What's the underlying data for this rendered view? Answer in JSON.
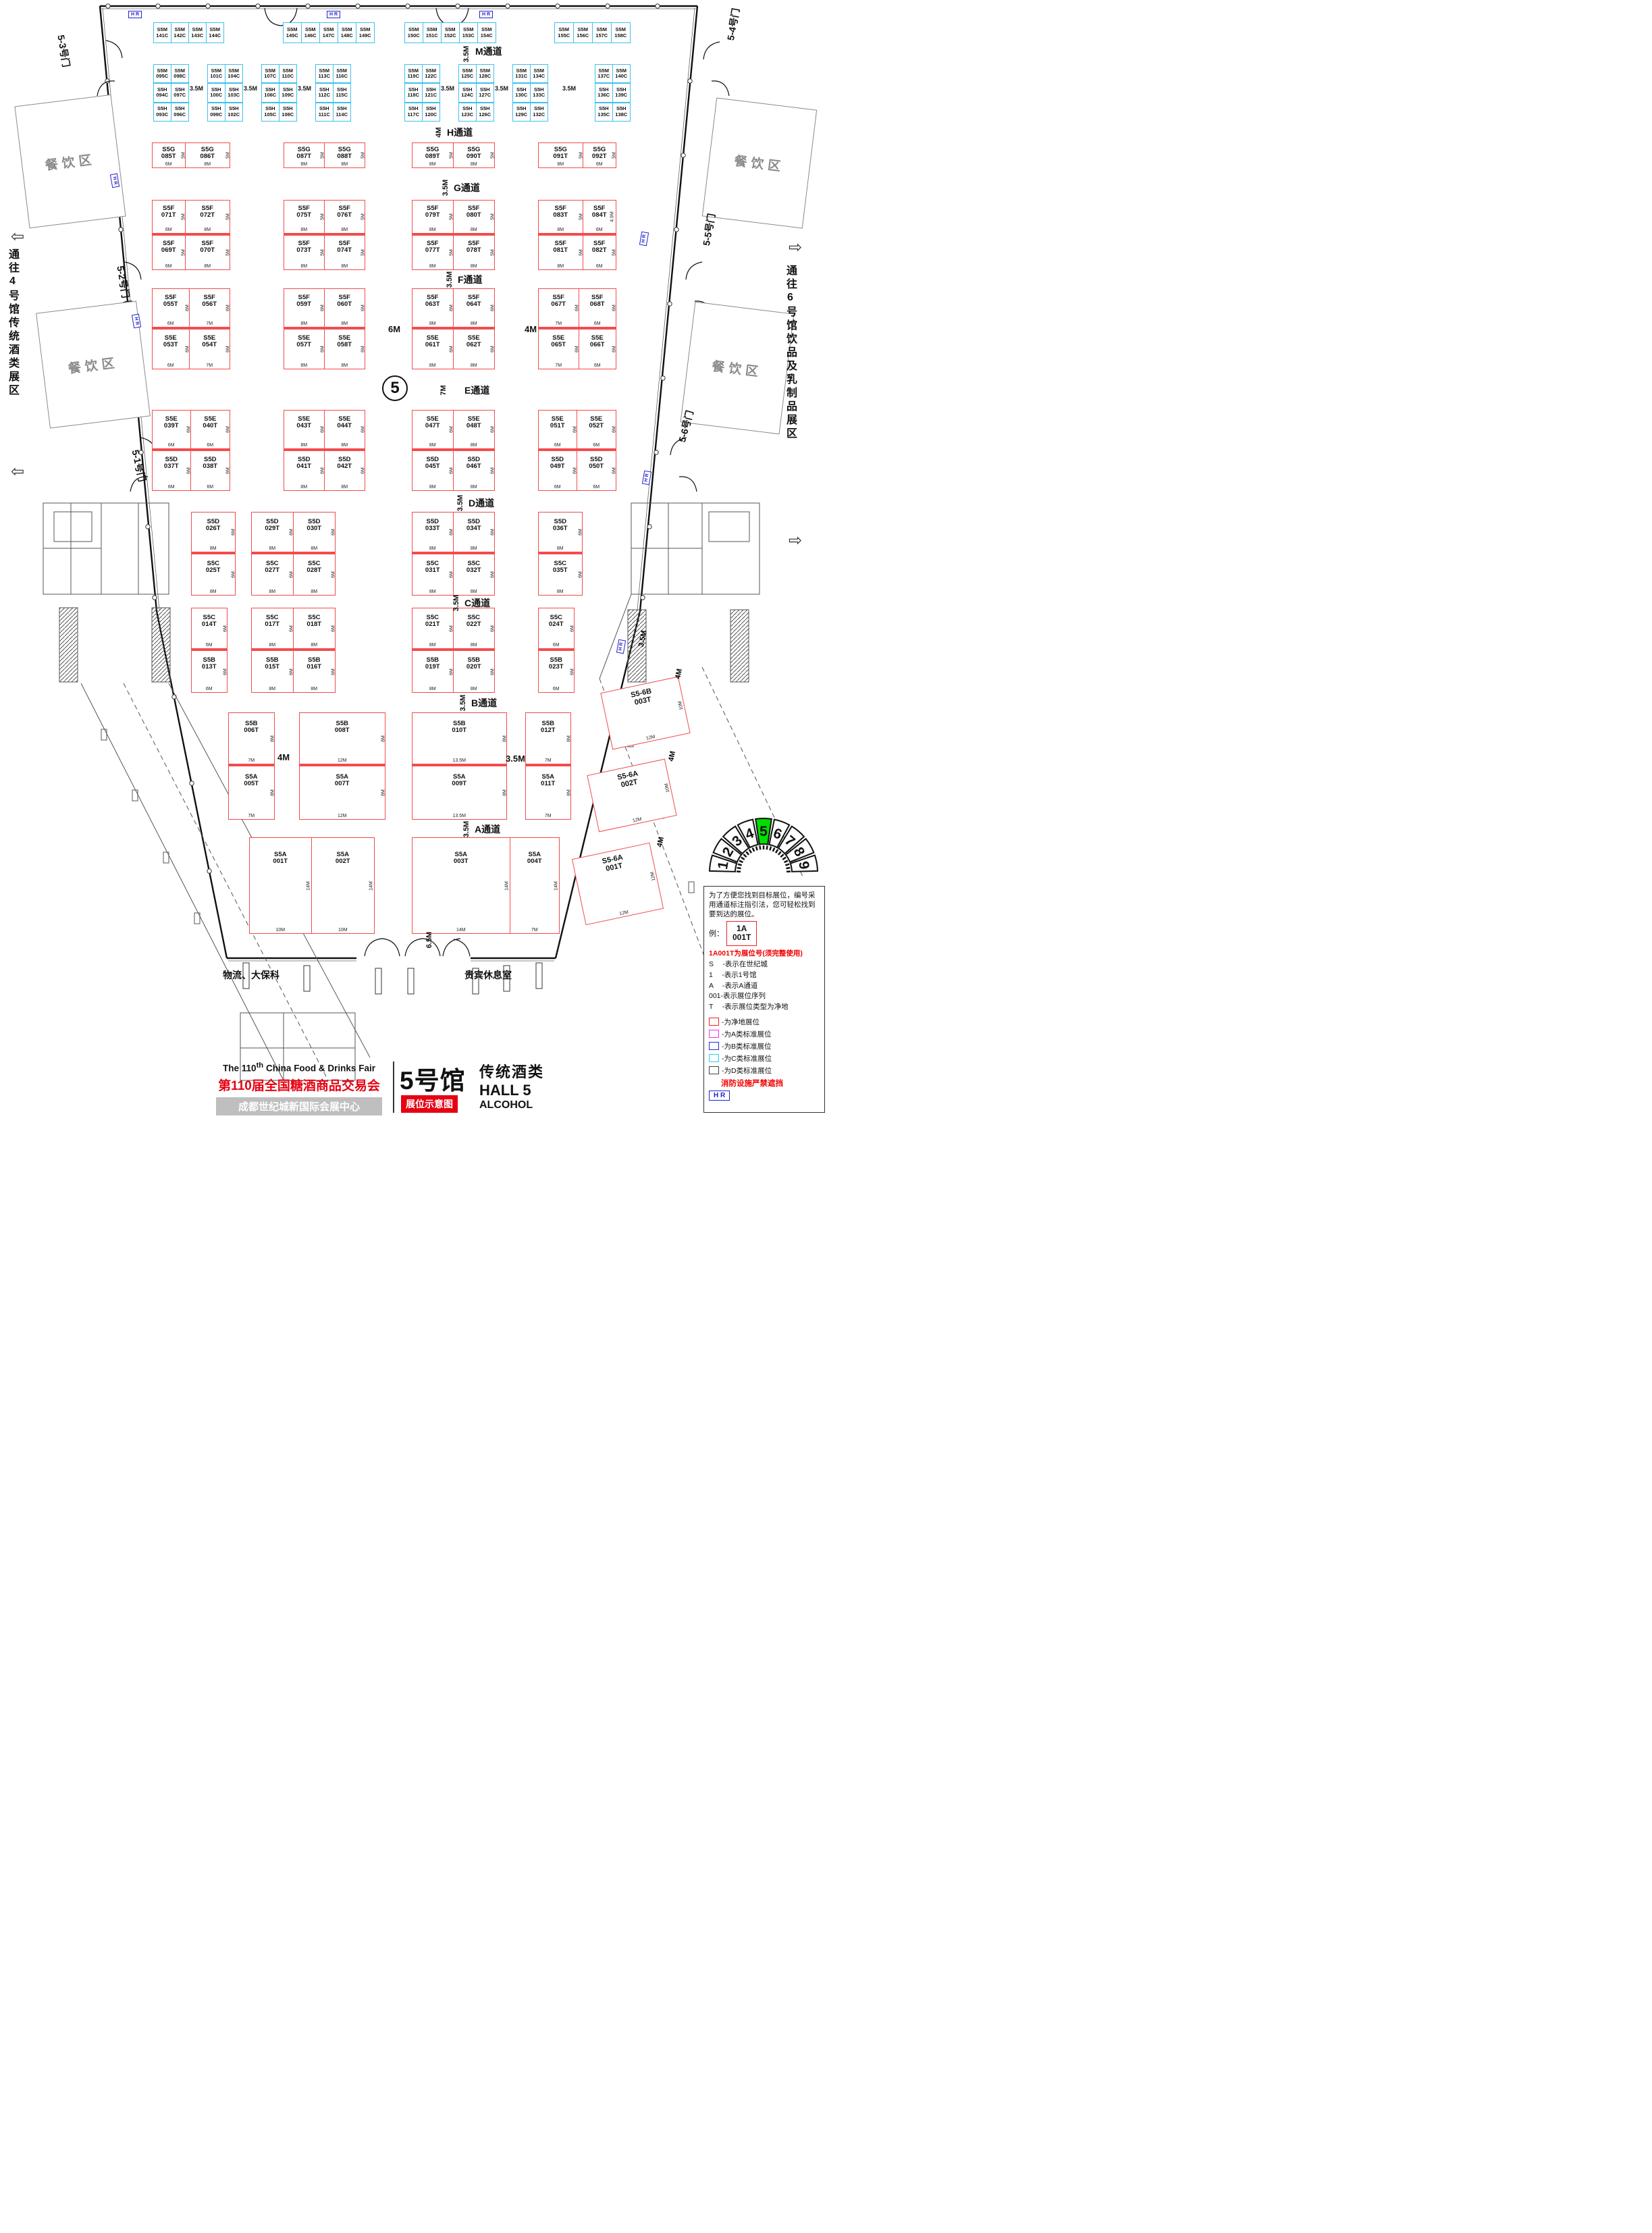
{
  "hall_circle": "5",
  "aisles": [
    {
      "dim": "3.5M",
      "name": "M通道"
    },
    {
      "dim": "4M",
      "name": "H通道"
    },
    {
      "dim": "3.5M",
      "name": "G通道"
    },
    {
      "dim": "3.5M",
      "name": "F通道"
    },
    {
      "dim": "7M",
      "name": "E通道"
    },
    {
      "dim": "3.5M",
      "name": "D通道"
    },
    {
      "dim": "3.5M",
      "name": "C通道"
    },
    {
      "dim": "3.5M",
      "name": "B通道"
    },
    {
      "dim": "3.5M",
      "name": "A通道"
    }
  ],
  "floating_dims": [
    "3.5M",
    "3.5M",
    "3.5M",
    "3.5M",
    "3.5M",
    "3.5M",
    "6M",
    "4M",
    "4M",
    "3.5M",
    "6.5M",
    "4M",
    "4M",
    "4M",
    "3.5M"
  ],
  "m_strip": [
    [
      "S5M 141C",
      "S5M 142C",
      "S5M 143C",
      "S5M 144C"
    ],
    [
      "S5M 145C",
      "S5M 146C",
      "S5M 147C",
      "S5M 148C",
      "S5M 149C"
    ],
    [
      "S5M 150C",
      "S5M 151C",
      "S5M 152C",
      "S5M 153C",
      "S5M 154C"
    ],
    [
      "S5M 155C",
      "S5M 156C",
      "S5M 157C",
      "S5M 158C"
    ]
  ],
  "mh_blocks": [
    [
      [
        "S5M 095C",
        "S5H 094C",
        "S5H 093C"
      ],
      [
        "S5M 098C",
        "S5H 097C",
        "S5H 096C"
      ]
    ],
    [
      [
        "S5M 101C",
        "S5H 100C",
        "S5H 099C"
      ],
      [
        "S5M 104C",
        "S5H 103C",
        "S5H 102C"
      ]
    ],
    [
      [
        "S5M 107C",
        "S5H 106C",
        "S5H 105C"
      ],
      [
        "S5M 110C",
        "S5H 109C",
        "S5H 108C"
      ]
    ],
    [
      [
        "S5M 113C",
        "S5H 112C",
        "S5H 111C"
      ],
      [
        "S5M 116C",
        "S5H 115C",
        "S5H 114C"
      ]
    ],
    [
      [
        "S5M 119C",
        "S5H 118C",
        "S5H 117C"
      ],
      [
        "S5M 122C",
        "S5H 121C",
        "S5H 120C"
      ]
    ],
    [
      [
        "S5M 125C",
        "S5H 124C",
        "S5H 123C"
      ],
      [
        "S5M 128C",
        "S5H 127C",
        "S5H 126C"
      ]
    ],
    [
      [
        "S5M 131C",
        "S5H 130C",
        "S5H 129C"
      ],
      [
        "S5M 134C",
        "S5H 133C",
        "S5H 132C"
      ]
    ],
    [
      [
        "S5M 137C",
        "S5H 136C",
        "S5H 135C"
      ],
      [
        "S5M 140C",
        "S5H 139C",
        "S5H 138C"
      ]
    ]
  ],
  "bands": {
    "g": [
      [
        [
          "S5G 085T",
          "6M",
          "5M"
        ],
        [
          "S5G 086T",
          "8M",
          "5M"
        ]
      ],
      [
        [
          "S5G 087T",
          "8M",
          "5M"
        ],
        [
          "S5G 088T",
          "8M",
          "5M"
        ]
      ],
      [
        [
          "S5G 089T",
          "8M",
          "5M"
        ],
        [
          "S5G 090T",
          "8M",
          "5M"
        ]
      ],
      [
        [
          "S5G 091T",
          "8M",
          "5M"
        ],
        [
          "S5G 092T",
          "6M",
          "5M"
        ]
      ]
    ],
    "f1": [
      [
        [
          "S5F 071T",
          "6M",
          "5M"
        ],
        [
          "S5F 072T",
          "8M",
          "5M"
        ]
      ],
      [
        [
          "S5F 075T",
          "8M",
          "5M"
        ],
        [
          "S5F 076T",
          "8M",
          "5M"
        ]
      ],
      [
        [
          "S5F 079T",
          "8M",
          "5M"
        ],
        [
          "S5F 080T",
          "8M",
          "5M"
        ]
      ],
      [
        [
          "S5F 083T",
          "8M",
          "5M"
        ],
        [
          "S5F 084T",
          "6M",
          "4.9M"
        ]
      ]
    ],
    "f2": [
      [
        [
          "S5F 069T",
          "6M",
          "5M"
        ],
        [
          "S5F 070T",
          "8M",
          "5M"
        ]
      ],
      [
        [
          "S5F 073T",
          "8M",
          "5M"
        ],
        [
          "S5F 074T",
          "8M",
          "5M"
        ]
      ],
      [
        [
          "S5F 077T",
          "8M",
          "5M"
        ],
        [
          "S5F 078T",
          "8M",
          "5M"
        ]
      ],
      [
        [
          "S5F 081T",
          "8M",
          "5M"
        ],
        [
          "S5F 082T",
          "6M",
          "5M"
        ]
      ]
    ],
    "e1": [
      [
        [
          "S5F 055T",
          "6M",
          "6M"
        ],
        [
          "S5F 056T",
          "7M",
          "6M"
        ]
      ],
      [
        [
          "S5F 059T",
          "8M",
          "6M"
        ],
        [
          "S5F 060T",
          "8M",
          "6M"
        ]
      ],
      [
        [
          "S5F 063T",
          "8M",
          "6M"
        ],
        [
          "S5F 064T",
          "8M",
          "6M"
        ]
      ],
      [
        [
          "S5F 067T",
          "7M",
          "6M"
        ],
        [
          "S5F 068T",
          "6M",
          "6M"
        ]
      ]
    ],
    "e2": [
      [
        [
          "S5E 053T",
          "6M",
          "6M"
        ],
        [
          "S5E 054T",
          "7M",
          "6M"
        ]
      ],
      [
        [
          "S5E 057T",
          "8M",
          "6M"
        ],
        [
          "S5E 058T",
          "8M",
          "6M"
        ]
      ],
      [
        [
          "S5E 061T",
          "8M",
          "6M"
        ],
        [
          "S5E 062T",
          "8M",
          "6M"
        ]
      ],
      [
        [
          "S5E 065T",
          "7M",
          "6M"
        ],
        [
          "S5E 066T",
          "6M",
          "6M"
        ]
      ]
    ],
    "ed1": [
      [
        [
          "S5E 039T",
          "6M",
          "6M"
        ],
        [
          "S5E 040T",
          "6M",
          "6M"
        ]
      ],
      [
        [
          "S5E 043T",
          "8M",
          "6M"
        ],
        [
          "S5E 044T",
          "8M",
          "6M"
        ]
      ],
      [
        [
          "S5E 047T",
          "8M",
          "6M"
        ],
        [
          "S5E 048T",
          "8M",
          "6M"
        ]
      ],
      [
        [
          "S5E 051T",
          "6M",
          "6M"
        ],
        [
          "S5E 052T",
          "6M",
          "6M"
        ]
      ]
    ],
    "ed2": [
      [
        [
          "S5D 037T",
          "6M",
          "6M"
        ],
        [
          "S5D 038T",
          "6M",
          "6M"
        ]
      ],
      [
        [
          "S5D 041T",
          "8M",
          "6M"
        ],
        [
          "S5D 042T",
          "8M",
          "6M"
        ]
      ],
      [
        [
          "S5D 045T",
          "8M",
          "6M"
        ],
        [
          "S5D 046T",
          "8M",
          "6M"
        ]
      ],
      [
        [
          "S5D 049T",
          "6M",
          "6M"
        ],
        [
          "S5D 050T",
          "6M",
          "6M"
        ]
      ]
    ],
    "dc1": [
      [
        [
          "S5D 026T",
          "8M",
          "6M"
        ]
      ],
      [
        [
          "S5D 029T",
          "8M",
          "6M"
        ],
        [
          "S5D 030T",
          "8M",
          "6M"
        ]
      ],
      [
        [
          "S5D 033T",
          "8M",
          "6M"
        ],
        [
          "S5D 034T",
          "8M",
          "6M"
        ]
      ],
      [
        [
          "S5D 036T",
          "8M",
          "6M"
        ]
      ]
    ],
    "dc2": [
      [
        [
          "S5C 025T",
          "8M",
          "6M"
        ]
      ],
      [
        [
          "S5C 027T",
          "8M",
          "6M"
        ],
        [
          "S5C 028T",
          "8M",
          "6M"
        ]
      ],
      [
        [
          "S5C 031T",
          "8M",
          "6M"
        ],
        [
          "S5C 032T",
          "8M",
          "6M"
        ]
      ],
      [
        [
          "S5C 035T",
          "8M",
          "6M"
        ]
      ]
    ],
    "cb1": [
      [
        [
          "S5C 014T",
          "6M",
          "6M"
        ]
      ],
      [
        [
          "S5C 017T",
          "8M",
          "6M"
        ],
        [
          "S5C 018T",
          "8M",
          "6M"
        ]
      ],
      [
        [
          "S5C 021T",
          "8M",
          "6M"
        ],
        [
          "S5C 022T",
          "8M",
          "6M"
        ]
      ],
      [
        [
          "S5C 024T",
          "6M",
          "6M"
        ]
      ]
    ],
    "cb2": [
      [
        [
          "S5B 013T",
          "6M",
          "6M"
        ]
      ],
      [
        [
          "S5B 015T",
          "8M",
          "6M"
        ],
        [
          "S5B 016T",
          "8M",
          "6M"
        ]
      ],
      [
        [
          "S5B 019T",
          "8M",
          "6M"
        ],
        [
          "S5B 020T",
          "8M",
          "6M"
        ]
      ],
      [
        [
          "S5B 023T",
          "6M",
          "6M"
        ]
      ]
    ],
    "ba1": [
      [
        [
          "S5B 006T",
          "7M",
          "8M"
        ]
      ],
      [
        [
          "S5B 008T",
          "12M",
          "8M"
        ]
      ],
      [
        [
          "S5B 010T",
          "13.5M",
          "8M"
        ]
      ],
      [
        [
          "S5B 012T",
          "7M",
          "8M"
        ]
      ]
    ],
    "ba2": [
      [
        [
          "S5A 005T",
          "7M",
          "8M"
        ]
      ],
      [
        [
          "S5A 007T",
          "12M",
          "8M"
        ]
      ],
      [
        [
          "S5A 009T",
          "13.5M",
          "8M"
        ]
      ],
      [
        [
          "S5A 011T",
          "7M",
          "8M"
        ]
      ]
    ],
    "a": [
      [
        [
          "S5A 001T",
          "10M",
          "14M"
        ],
        [
          "S5A 002T",
          "10M",
          "14M"
        ]
      ],
      [
        [
          "S5A 003T",
          "14M",
          "14M"
        ],
        [
          "S5A 004T",
          "7M",
          "14M"
        ]
      ]
    ]
  },
  "s56_booths": [
    [
      "S5-6B 003T",
      "12M",
      "10M"
    ],
    [
      "S5-6A 002T",
      "12M",
      "10M"
    ],
    [
      "S5-6A 001T",
      "12M",
      "12M"
    ]
  ],
  "doors": [
    "5-3号门",
    "5-2号门",
    "5-1号门",
    "5-4号门",
    "5-5号门",
    "5-6号门"
  ],
  "side_notes": {
    "left": "通往4号馆传统酒类展区",
    "right": "通往6号馆饮品及乳制品展区"
  },
  "dining_label": "餐饮区",
  "rooms": {
    "logistics": "物流、大保科",
    "vip": "贵宾休息室"
  },
  "hr_label": "H R",
  "selector": {
    "halls": [
      "1",
      "2",
      "3",
      "4",
      "5",
      "6",
      "7",
      "8",
      "9"
    ],
    "active": "5",
    "active_color": "#00dd00"
  },
  "legend": {
    "intro": "为了方便您找到目标展位，编号采用通道标注指引法，您可轻松找到要到达的展位。",
    "example_label": "例：",
    "example_id": "1A\n001T",
    "headline": "1A001T为展位号(须完整使用)",
    "items": [
      "S　 -表示在世纪城",
      "1 　-表示1号馆",
      "A 　-表示A通道",
      "001-表示展位序列",
      "T 　-表示展位类型为净地"
    ],
    "classes": [
      {
        "color": "#f02020",
        "label": "-为净地展位"
      },
      {
        "color": "#f030f0",
        "label": "-为A类标准展位"
      },
      {
        "color": "#2828e0",
        "label": "-为B类标准展位"
      },
      {
        "color": "#25d5ea",
        "label": "-为C类标准展位"
      },
      {
        "color": "#444444",
        "label": "-为D类标准展位"
      }
    ],
    "fire_note": "消防设施严禁遮挡"
  },
  "title_block": {
    "en_prefix": "The 110",
    "en_sup": "th",
    "en_suffix": " China Food & Drinks Fair",
    "cn": "第110届全国糖酒商品交易会",
    "venue": "成都世纪城新国际会展中心",
    "hall_cn": "5号馆",
    "badge": "展位示意图",
    "hall_type": "传统酒类",
    "hall_en": "HALL 5",
    "hall_en_sub": "ALCOHOL"
  }
}
